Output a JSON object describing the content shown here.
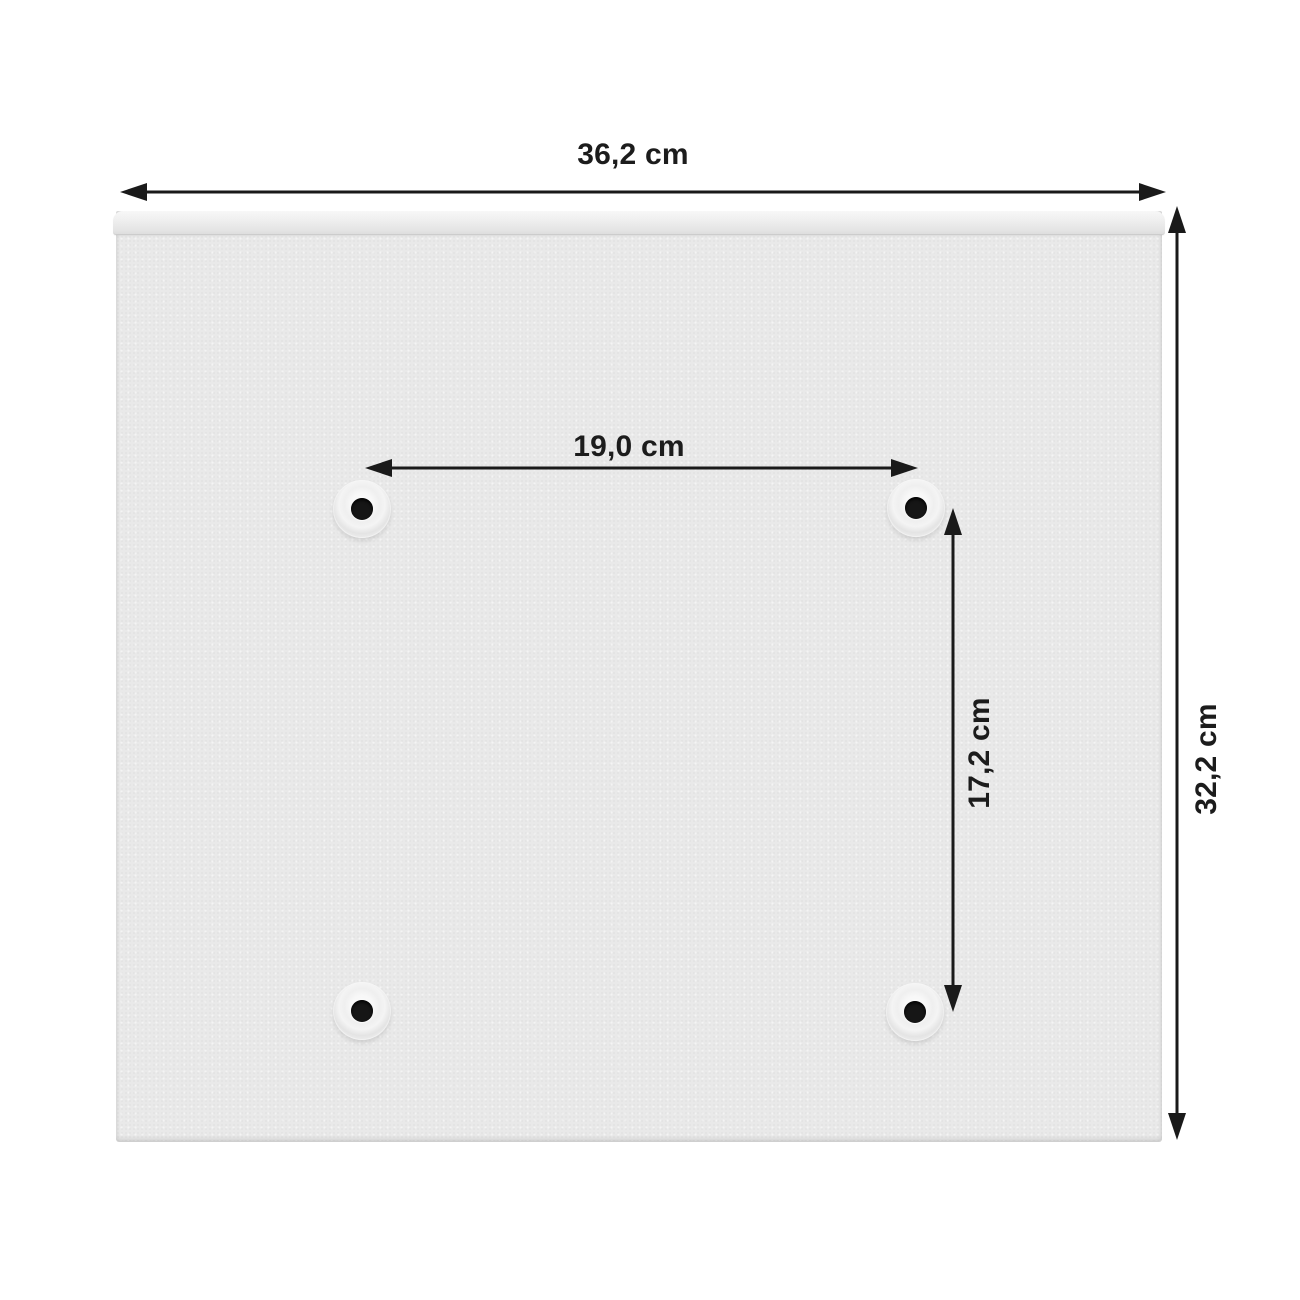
{
  "dimensions": {
    "width": {
      "label": "36,2 cm"
    },
    "height": {
      "label": "32,2 cm"
    },
    "hole_spacing_horizontal": {
      "label": "19,0 cm"
    },
    "hole_spacing_vertical": {
      "label": "17,2 cm"
    }
  },
  "colors": {
    "background": "#ffffff",
    "panel": "#e9e9e9",
    "panel_highlight": "#f8f8f8",
    "dimension_line": "#1a1a1a",
    "text": "#1c1c1c",
    "hole_bore": "#161616"
  }
}
